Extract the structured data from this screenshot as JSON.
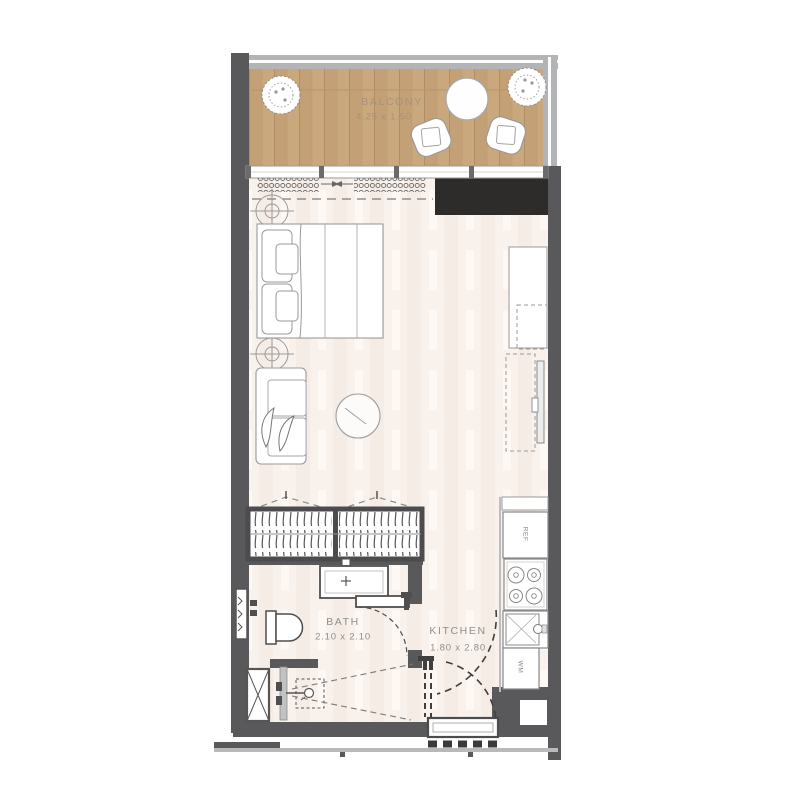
{
  "rooms": {
    "balcony": {
      "label": "BALCONY",
      "dimensions": "4.25 x 1.50"
    },
    "bath": {
      "label": "BATH",
      "dimensions": "2.10 x 2.10"
    },
    "kitchen": {
      "label": "KITCHEN",
      "dimensions": "1.80 x 2.80"
    }
  },
  "appliances": {
    "refrigerator": "REF.",
    "washing_machine": "WM"
  },
  "colors": {
    "wall": "#59595c",
    "dark_unit": "#2d2c2b",
    "wood_deck": "#c9a87e",
    "floor": "#f8f1ec",
    "railing": "#b3b4b6",
    "furniture_line": "#9a9a9a"
  }
}
